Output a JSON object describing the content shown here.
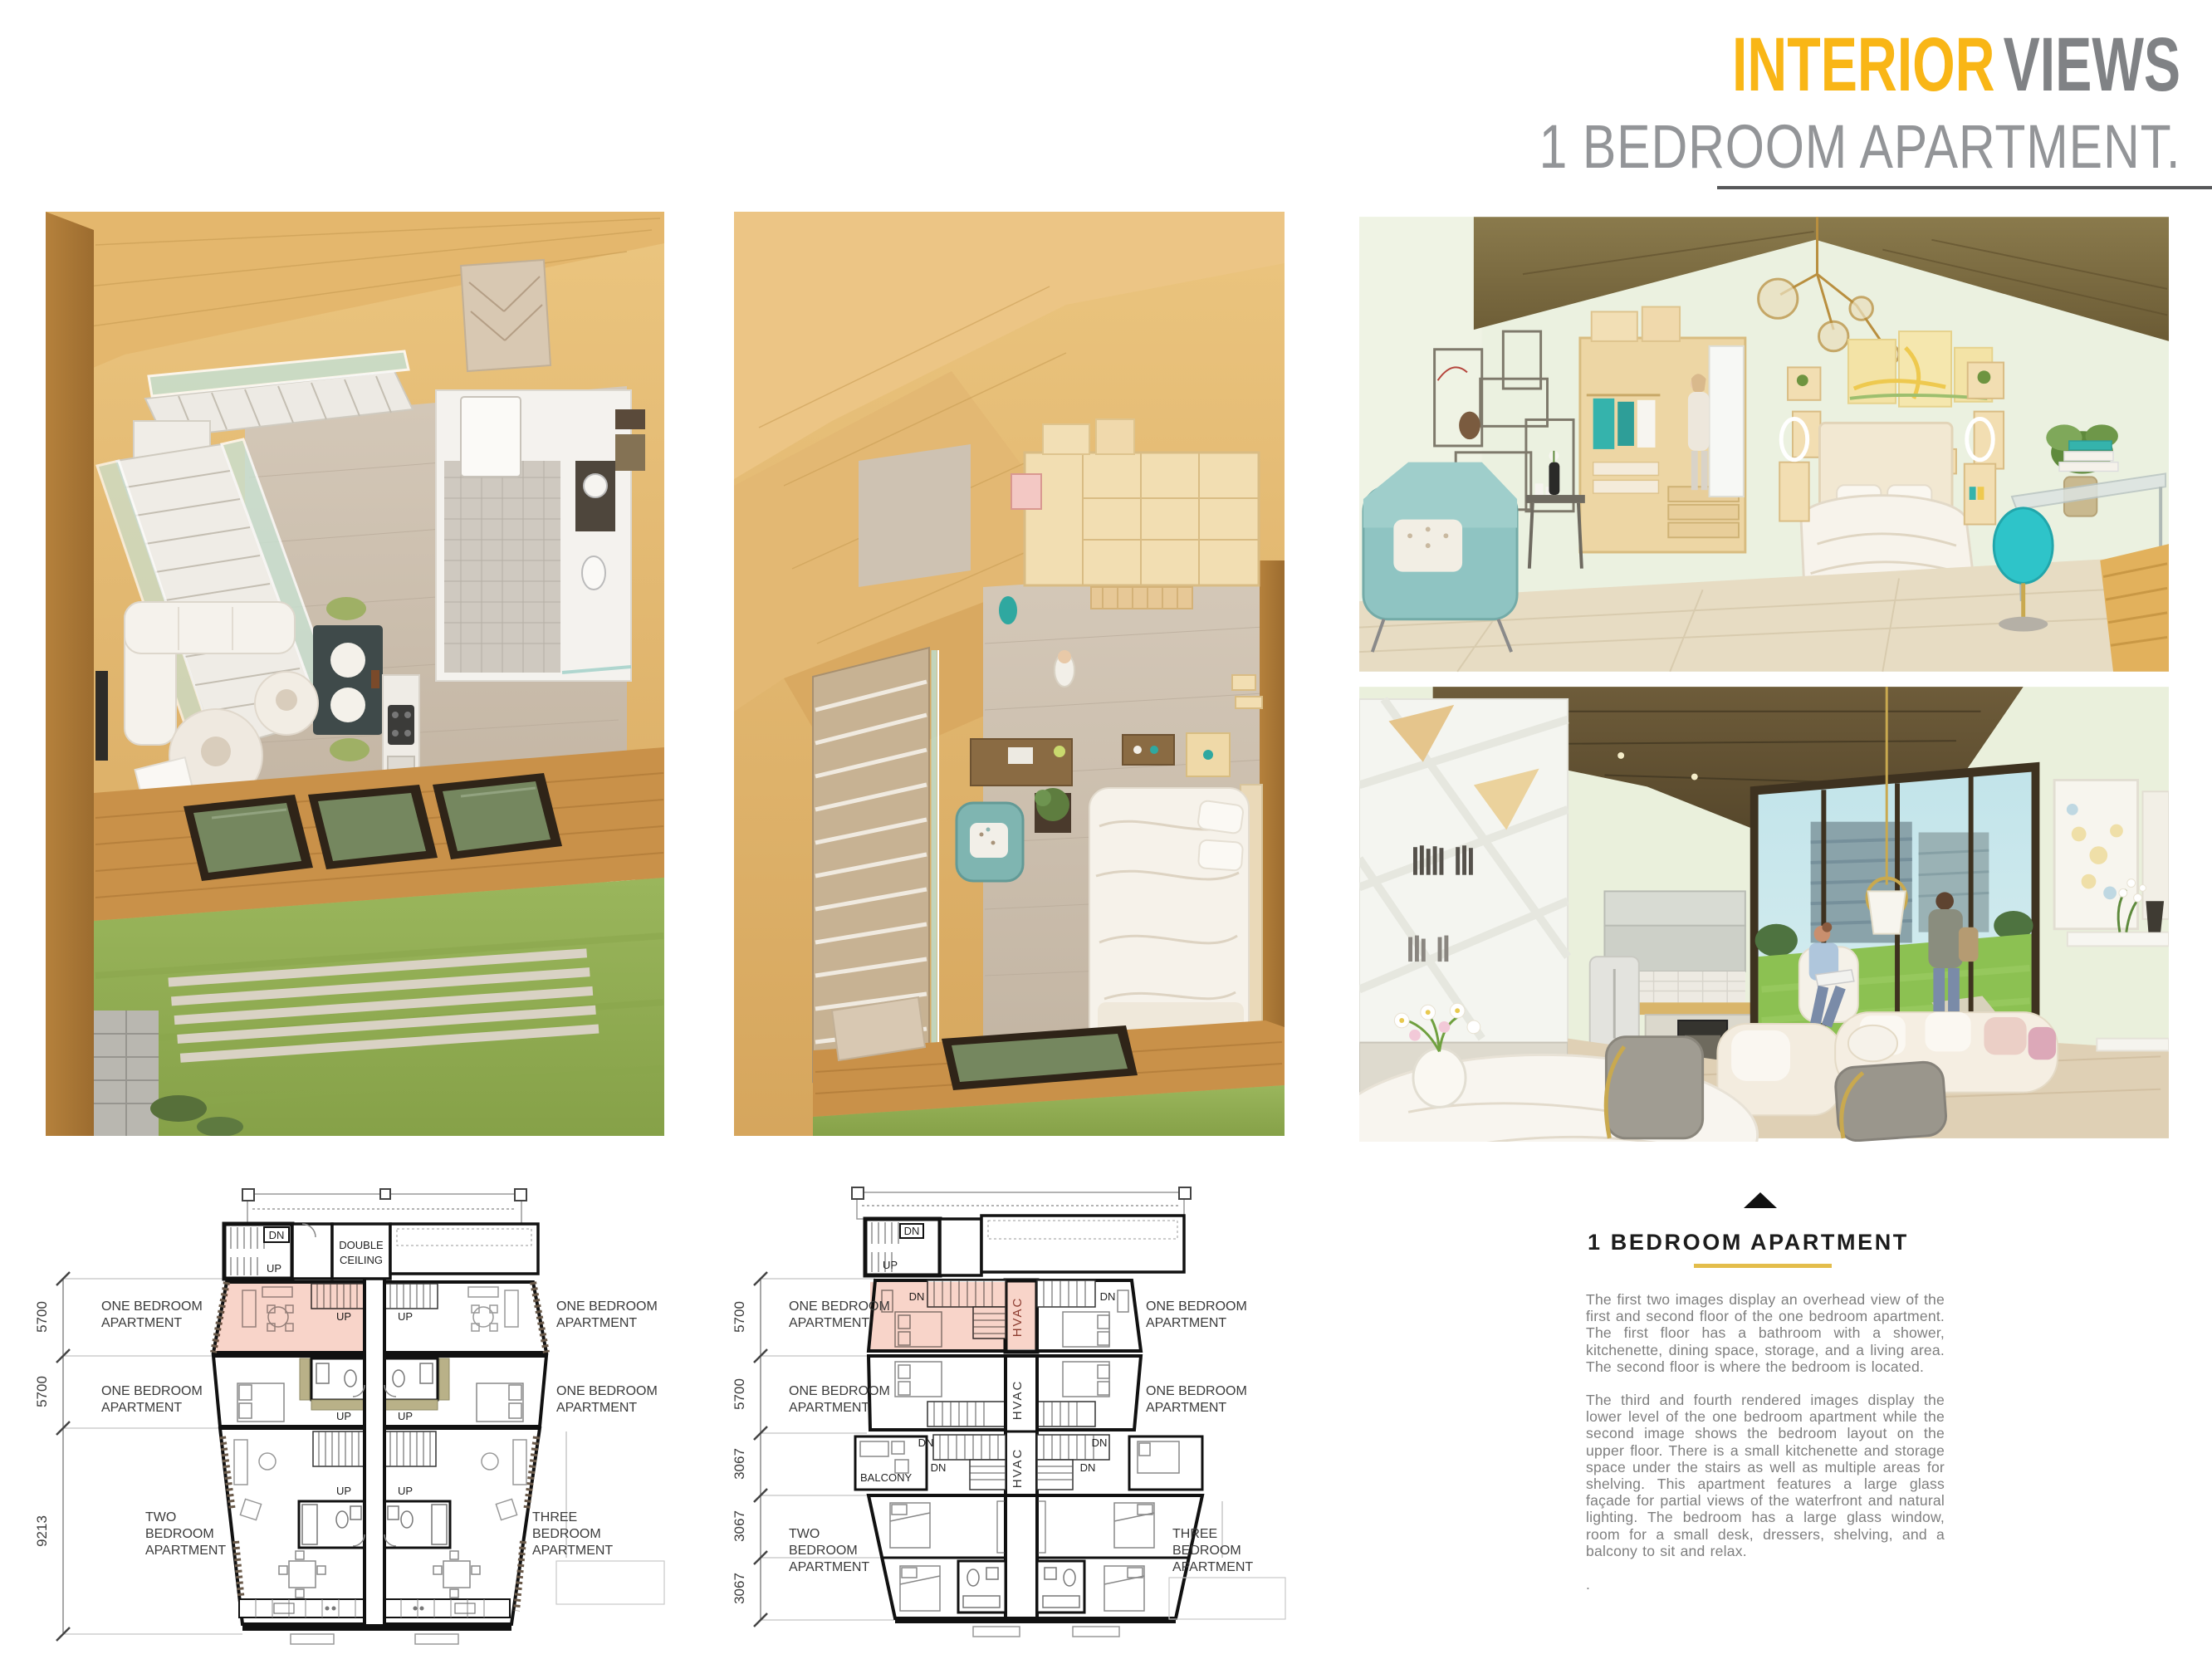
{
  "header": {
    "title_accent": "INTERIOR",
    "title_rest": "VIEWS",
    "subtitle": "1 BEDROOM APARTMENT."
  },
  "plans": {
    "first": {
      "dims": [
        "5700",
        "5700",
        "9213"
      ],
      "units_left": [
        {
          "a": "ONE BEDROOM",
          "b": "APARTMENT"
        },
        {
          "a": "ONE BEDROOM",
          "b": "APARTMENT"
        },
        {
          "a": "TWO",
          "b": "BEDROOM",
          "c": "APARTMENT"
        }
      ],
      "units_right": [
        {
          "a": "ONE BEDROOM",
          "b": "APARTMENT"
        },
        {
          "a": "ONE BEDROOM",
          "b": "APARTMENT"
        },
        {
          "a": "THREE",
          "b": "BEDROOM",
          "c": "APARTMENT"
        }
      ],
      "double_ceiling": {
        "a": "DOUBLE",
        "b": "CEILING"
      },
      "dn": "DN",
      "up": "UP"
    },
    "second": {
      "dims": [
        "5700",
        "5700",
        "3067",
        "3067",
        "3067"
      ],
      "units_left": [
        {
          "a": "ONE BEDROOM",
          "b": "APARTMENT"
        },
        {
          "a": "ONE BEDROOM",
          "b": "APARTMENT"
        },
        {
          "a": "TWO",
          "b": "BEDROOM",
          "c": "APARTMENT"
        }
      ],
      "units_right": [
        {
          "a": "ONE BEDROOM",
          "b": "APARTMENT"
        },
        {
          "a": "ONE BEDROOM",
          "b": "APARTMENT"
        },
        {
          "a": "THREE",
          "b": "BEDROOM",
          "c": "APARTMENT"
        }
      ],
      "balcony": "BALCONY",
      "hvac": "HVAC",
      "dn": "DN",
      "up": "UP"
    }
  },
  "info": {
    "heading": "1 BEDROOM APARTMENT",
    "para1": "The first two images display an overhead view of the first and second floor of the one bedroom apartment. The first floor has a bathroom with a shower, kitchenette, dining space, storage, and a living area. The second floor is where the bedroom is located.",
    "para2": "The third and fourth rendered images display the lower level of the one bedroom apartment while the second image shows the bedroom layout on the upper floor. There is a small kitchenette and storage space under the stairs as well as multiple areas for shelving. This apartment features a large glass façade for partial views of the waterfront and natural lighting. The bedroom has a large glass window, room for a small desk, dressers, shelving, and a balcony to sit and relax.",
    "para3": "."
  },
  "colors": {
    "accent_yellow": "#F9B616",
    "title_gray": "#808285",
    "subtitle_gray": "#939598",
    "body_gray": "#7E7E7E",
    "heading_underline": "#E3BD4B",
    "plan_highlight": "#F7C9BB",
    "plan_olive": "#B9B188",
    "hvac_red": "#8B3A2E",
    "lawn_green": "#93AF54",
    "wood_tan": "#E2B977",
    "wall_green": "#EAF0DC",
    "teal": "#7FB5B1"
  }
}
